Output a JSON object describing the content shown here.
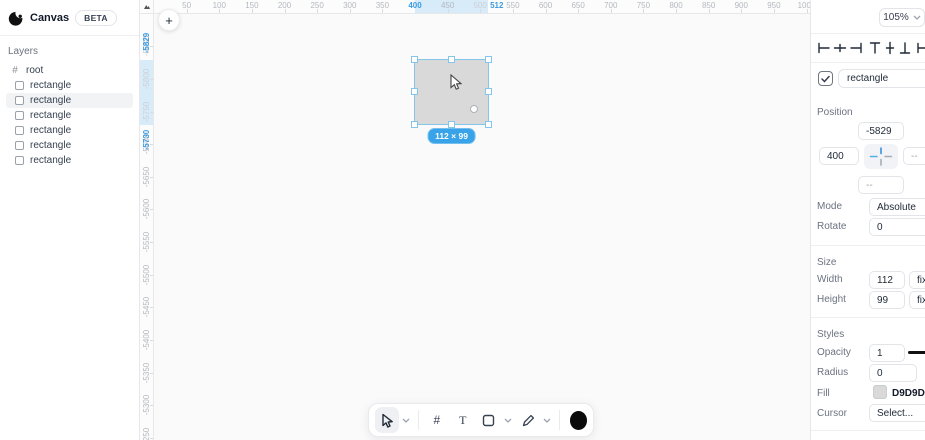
{
  "app": {
    "name": "Canvas",
    "badge": "BETA"
  },
  "layers": {
    "title": "Layers",
    "root_label": "root",
    "items": [
      {
        "label": "rectangle"
      },
      {
        "label": "rectangle"
      },
      {
        "label": "rectangle"
      },
      {
        "label": "rectangle"
      },
      {
        "label": "rectangle"
      },
      {
        "label": "rectangle"
      }
    ],
    "selected_index": 1
  },
  "canvas": {
    "add_button_glyph": "+",
    "h_ruler": {
      "unit_to_px": 0.6525,
      "labels": [
        50,
        100,
        150,
        200,
        250,
        300,
        350,
        450,
        500,
        550,
        600,
        650,
        700,
        750,
        800,
        850,
        900,
        950,
        1000
      ],
      "faint_labels": [
        500
      ],
      "highlight_start": 400,
      "highlight_end": 512
    },
    "v_ruler": {
      "unit_to_px": 0.6525,
      "labels": [
        -5850,
        -5800,
        -5750,
        -5700,
        -5650,
        -5600,
        -5550,
        -5500,
        -5450,
        -5400,
        -5350,
        -5300,
        -5250
      ],
      "faint_labels": [
        -5850,
        -5800,
        -5750
      ],
      "highlight_start": -5829,
      "highlight_end": -5730
    },
    "selection": {
      "size_badge": "112 × 99",
      "fill": "#D9D9D9"
    }
  },
  "toolbar": {
    "frame_glyph": "#",
    "text_glyph": "T"
  },
  "inspector": {
    "zoom_value": "105%",
    "name_field": "rectangle",
    "position": {
      "title": "Position",
      "y_value": "-5829",
      "x_value": "400",
      "right_value": "--",
      "bottom_value": "--",
      "mode_label": "Mode",
      "mode_value": "Absolute",
      "rotate_label": "Rotate",
      "rotate_value": "0"
    },
    "size": {
      "title": "Size",
      "width_label": "Width",
      "width_value": "112",
      "width_mode": "fixed",
      "height_label": "Height",
      "height_value": "99",
      "height_mode": "fixed"
    },
    "styles": {
      "title": "Styles",
      "opacity_label": "Opacity",
      "opacity_value": "1",
      "radius_label": "Radius",
      "radius_value": "0",
      "fill_label": "Fill",
      "fill_value": "D9D9D9",
      "cursor_label": "Cursor",
      "cursor_value": "Select..."
    }
  },
  "colors": {
    "accent_blue": "#3b9ce2",
    "selection_stroke": "#85c5e8",
    "shape_fill": "#d9d9d9",
    "ruler_band": "#d7ebf9"
  }
}
